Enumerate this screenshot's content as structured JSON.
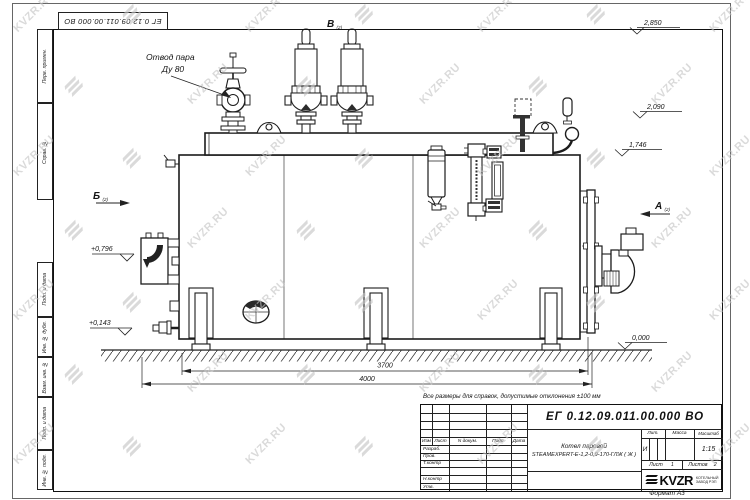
{
  "watermark": {
    "text": "KVZR.RU"
  },
  "stamp": {
    "code": "ЕГ 0.12.09.011.00.000  ВО"
  },
  "margin_columns": {
    "items": [
      "Перв. примен.",
      "Справ. №",
      "Подп. и дата",
      "Инв. № дубл.",
      "Взам. инв. №",
      "Подп. и дата",
      "Инв. № подл."
    ]
  },
  "note": "Все размеры для справок, допустимые отклонения ±100 мм",
  "drawing": {
    "callout": {
      "line1": "Отвод пара",
      "line2": "Ду 80"
    },
    "views": {
      "b": "Б",
      "a": "А",
      "v": "В",
      "sheet_ref": "(2)"
    },
    "elevations": {
      "e2850": "2,850",
      "e2090": "2,090",
      "e1746": "1,746",
      "e0000": "0,000",
      "e0796": "+0,796",
      "e0143": "+0,143"
    },
    "dimensions": {
      "d3700": "3700",
      "d4000": "4000"
    }
  },
  "title_block": {
    "doc_number": "ЕГ 0.12.09.011.00.000  ВО",
    "name_line1": "Котел паровой",
    "name_line2": "STEAMEXPERT-Е-1,2-0,9-170-ГЛЖ ( Ж )",
    "headers": {
      "izm": "Изм",
      "list": "Лист",
      "ndoc": "N докум.",
      "podp": "Подп.",
      "data": "Дата",
      "lit": "Лит.",
      "massa": "Масса",
      "masshtab": "Масштаб"
    },
    "rows": {
      "razrab": "Разраб.",
      "prov": "Пров.",
      "tkontr": "Т.контр",
      "nkontr": "Н.контр",
      "utv": "Утв."
    },
    "lit_value": "И",
    "scale": "1:15",
    "sheet_label": "Лист",
    "sheet_value": "1",
    "sheets_label": "Листов",
    "sheets_value": "2",
    "logo_text": "KVZR",
    "logo_sub1": "КОТЕЛЬНЫЙ",
    "logo_sub2": "ЗАВОД РЭП",
    "format_label": "Формат А3"
  }
}
